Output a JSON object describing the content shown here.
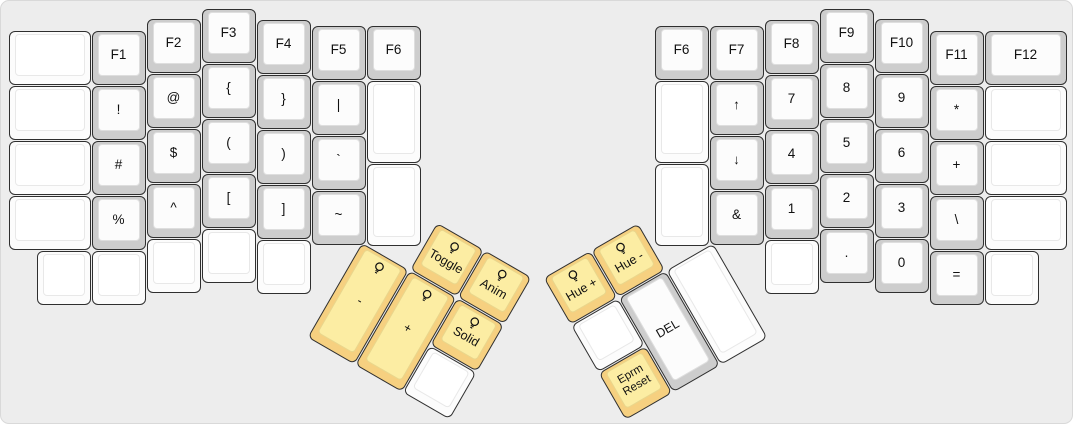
{
  "keyboard": {
    "description": "ErgoDox split keyboard layout, function/symbol layer with RGB thumb controls",
    "case_background": "#ededed",
    "case_border": "#d9d9d9",
    "outline": "#2f2f2f",
    "label_color": "#111111",
    "key_colors": {
      "white": {
        "side": "#fcfcfc",
        "top": "#ffffff",
        "top_border": "#e8e8e8"
      },
      "gray": {
        "side": "#cdcdcd",
        "top": "#fcfcfc",
        "top_border": "#dedede"
      },
      "yellow": {
        "side": "#f6d080",
        "top": "#fceda3",
        "top_border": "#e9d68c"
      }
    }
  },
  "keys": [
    {
      "name": "key-blank",
      "label": "",
      "style": "white",
      "icon": ""
    },
    {
      "name": "key-blank",
      "label": "",
      "style": "white",
      "icon": ""
    },
    {
      "name": "key-blank",
      "label": "",
      "style": "white",
      "icon": ""
    },
    {
      "name": "key-blank",
      "label": "",
      "style": "white",
      "icon": ""
    },
    {
      "name": "key-blank",
      "label": "",
      "style": "white",
      "icon": ""
    },
    {
      "name": "key-f1",
      "label": "F1",
      "style": "gray",
      "icon": ""
    },
    {
      "name": "key-exclamation",
      "label": "!",
      "style": "gray",
      "icon": ""
    },
    {
      "name": "key-hash",
      "label": "#",
      "style": "gray",
      "icon": ""
    },
    {
      "name": "key-percent",
      "label": "%",
      "style": "gray",
      "icon": ""
    },
    {
      "name": "key-blank",
      "label": "",
      "style": "white",
      "icon": ""
    },
    {
      "name": "key-f2",
      "label": "F2",
      "style": "gray",
      "icon": ""
    },
    {
      "name": "key-at",
      "label": "@",
      "style": "gray",
      "icon": ""
    },
    {
      "name": "key-dollar",
      "label": "$",
      "style": "gray",
      "icon": ""
    },
    {
      "name": "key-caret",
      "label": "^",
      "style": "gray",
      "icon": ""
    },
    {
      "name": "key-blank",
      "label": "",
      "style": "white",
      "icon": ""
    },
    {
      "name": "key-f3",
      "label": "F3",
      "style": "gray",
      "icon": ""
    },
    {
      "name": "key-left-brace",
      "label": "{",
      "style": "gray",
      "icon": ""
    },
    {
      "name": "key-left-paren",
      "label": "(",
      "style": "gray",
      "icon": ""
    },
    {
      "name": "key-left-bracket",
      "label": "[",
      "style": "gray",
      "icon": ""
    },
    {
      "name": "key-blank",
      "label": "",
      "style": "white",
      "icon": ""
    },
    {
      "name": "key-f4",
      "label": "F4",
      "style": "gray",
      "icon": ""
    },
    {
      "name": "key-right-brace",
      "label": "}",
      "style": "gray",
      "icon": ""
    },
    {
      "name": "key-right-paren",
      "label": ")",
      "style": "gray",
      "icon": ""
    },
    {
      "name": "key-right-bracket",
      "label": "]",
      "style": "gray",
      "icon": ""
    },
    {
      "name": "key-blank",
      "label": "",
      "style": "white",
      "icon": ""
    },
    {
      "name": "key-f5",
      "label": "F5",
      "style": "gray",
      "icon": ""
    },
    {
      "name": "key-pipe",
      "label": "|",
      "style": "gray",
      "icon": ""
    },
    {
      "name": "key-backtick",
      "label": "`",
      "style": "gray",
      "icon": ""
    },
    {
      "name": "key-tilde",
      "label": "~",
      "style": "gray",
      "icon": ""
    },
    {
      "name": "key-f6-left",
      "label": "F6",
      "style": "gray",
      "icon": ""
    },
    {
      "name": "key-blank",
      "label": "",
      "style": "white",
      "icon": ""
    },
    {
      "name": "key-blank",
      "label": "",
      "style": "white",
      "icon": ""
    },
    {
      "name": "key-toggle",
      "label": "Toggle",
      "style": "yellow",
      "icon": "lightbulb"
    },
    {
      "name": "key-anim",
      "label": "Anim",
      "style": "yellow",
      "icon": "lightbulb"
    },
    {
      "name": "key-thumb-minus",
      "label": "-",
      "style": "yellow",
      "icon": "lightbulb"
    },
    {
      "name": "key-thumb-plus",
      "label": "+",
      "style": "yellow",
      "icon": "lightbulb"
    },
    {
      "name": "key-solid",
      "label": "Solid",
      "style": "yellow",
      "icon": "lightbulb"
    },
    {
      "name": "key-blank",
      "label": "",
      "style": "white",
      "icon": ""
    },
    {
      "name": "key-f6-right",
      "label": "F6",
      "style": "gray",
      "icon": ""
    },
    {
      "name": "key-blank",
      "label": "",
      "style": "white",
      "icon": ""
    },
    {
      "name": "key-blank",
      "label": "",
      "style": "white",
      "icon": ""
    },
    {
      "name": "key-f7",
      "label": "F7",
      "style": "gray",
      "icon": ""
    },
    {
      "name": "key-up-arrow",
      "label": "↑",
      "style": "gray",
      "icon": ""
    },
    {
      "name": "key-down-arrow",
      "label": "↓",
      "style": "gray",
      "icon": ""
    },
    {
      "name": "key-ampersand",
      "label": "&",
      "style": "gray",
      "icon": ""
    },
    {
      "name": "key-f8",
      "label": "F8",
      "style": "gray",
      "icon": ""
    },
    {
      "name": "key-7",
      "label": "7",
      "style": "gray",
      "icon": ""
    },
    {
      "name": "key-4",
      "label": "4",
      "style": "gray",
      "icon": ""
    },
    {
      "name": "key-1",
      "label": "1",
      "style": "gray",
      "icon": ""
    },
    {
      "name": "key-blank",
      "label": "",
      "style": "white",
      "icon": ""
    },
    {
      "name": "key-f9",
      "label": "F9",
      "style": "gray",
      "icon": ""
    },
    {
      "name": "key-8",
      "label": "8",
      "style": "gray",
      "icon": ""
    },
    {
      "name": "key-5",
      "label": "5",
      "style": "gray",
      "icon": ""
    },
    {
      "name": "key-2",
      "label": "2",
      "style": "gray",
      "icon": ""
    },
    {
      "name": "key-period",
      "label": ".",
      "style": "gray",
      "icon": ""
    },
    {
      "name": "key-f10",
      "label": "F10",
      "style": "gray",
      "icon": ""
    },
    {
      "name": "key-9",
      "label": "9",
      "style": "gray",
      "icon": ""
    },
    {
      "name": "key-6",
      "label": "6",
      "style": "gray",
      "icon": ""
    },
    {
      "name": "key-3",
      "label": "3",
      "style": "gray",
      "icon": ""
    },
    {
      "name": "key-0",
      "label": "0",
      "style": "gray",
      "icon": ""
    },
    {
      "name": "key-f11",
      "label": "F11",
      "style": "gray",
      "icon": ""
    },
    {
      "name": "key-asterisk",
      "label": "*",
      "style": "gray",
      "icon": ""
    },
    {
      "name": "key-plus",
      "label": "+",
      "style": "gray",
      "icon": ""
    },
    {
      "name": "key-backslash",
      "label": "\\",
      "style": "gray",
      "icon": ""
    },
    {
      "name": "key-equals",
      "label": "=",
      "style": "gray",
      "icon": ""
    },
    {
      "name": "key-f12",
      "label": "F12",
      "style": "gray",
      "icon": ""
    },
    {
      "name": "key-blank",
      "label": "",
      "style": "white",
      "icon": ""
    },
    {
      "name": "key-blank",
      "label": "",
      "style": "white",
      "icon": ""
    },
    {
      "name": "key-blank",
      "label": "",
      "style": "white",
      "icon": ""
    },
    {
      "name": "key-blank",
      "label": "",
      "style": "white",
      "icon": ""
    },
    {
      "name": "key-hue-plus",
      "label": "Hue +",
      "style": "yellow",
      "icon": "lightbulb"
    },
    {
      "name": "key-hue-minus",
      "label": "Hue -",
      "style": "yellow",
      "icon": "lightbulb"
    },
    {
      "name": "key-blank",
      "label": "",
      "style": "white",
      "icon": ""
    },
    {
      "name": "key-del",
      "label": "DEL",
      "style": "gray",
      "icon": ""
    },
    {
      "name": "key-blank",
      "label": "",
      "style": "white",
      "icon": ""
    },
    {
      "name": "key-eprm-reset",
      "label": "Eprm\nReset",
      "style": "yellow",
      "icon": ""
    }
  ]
}
